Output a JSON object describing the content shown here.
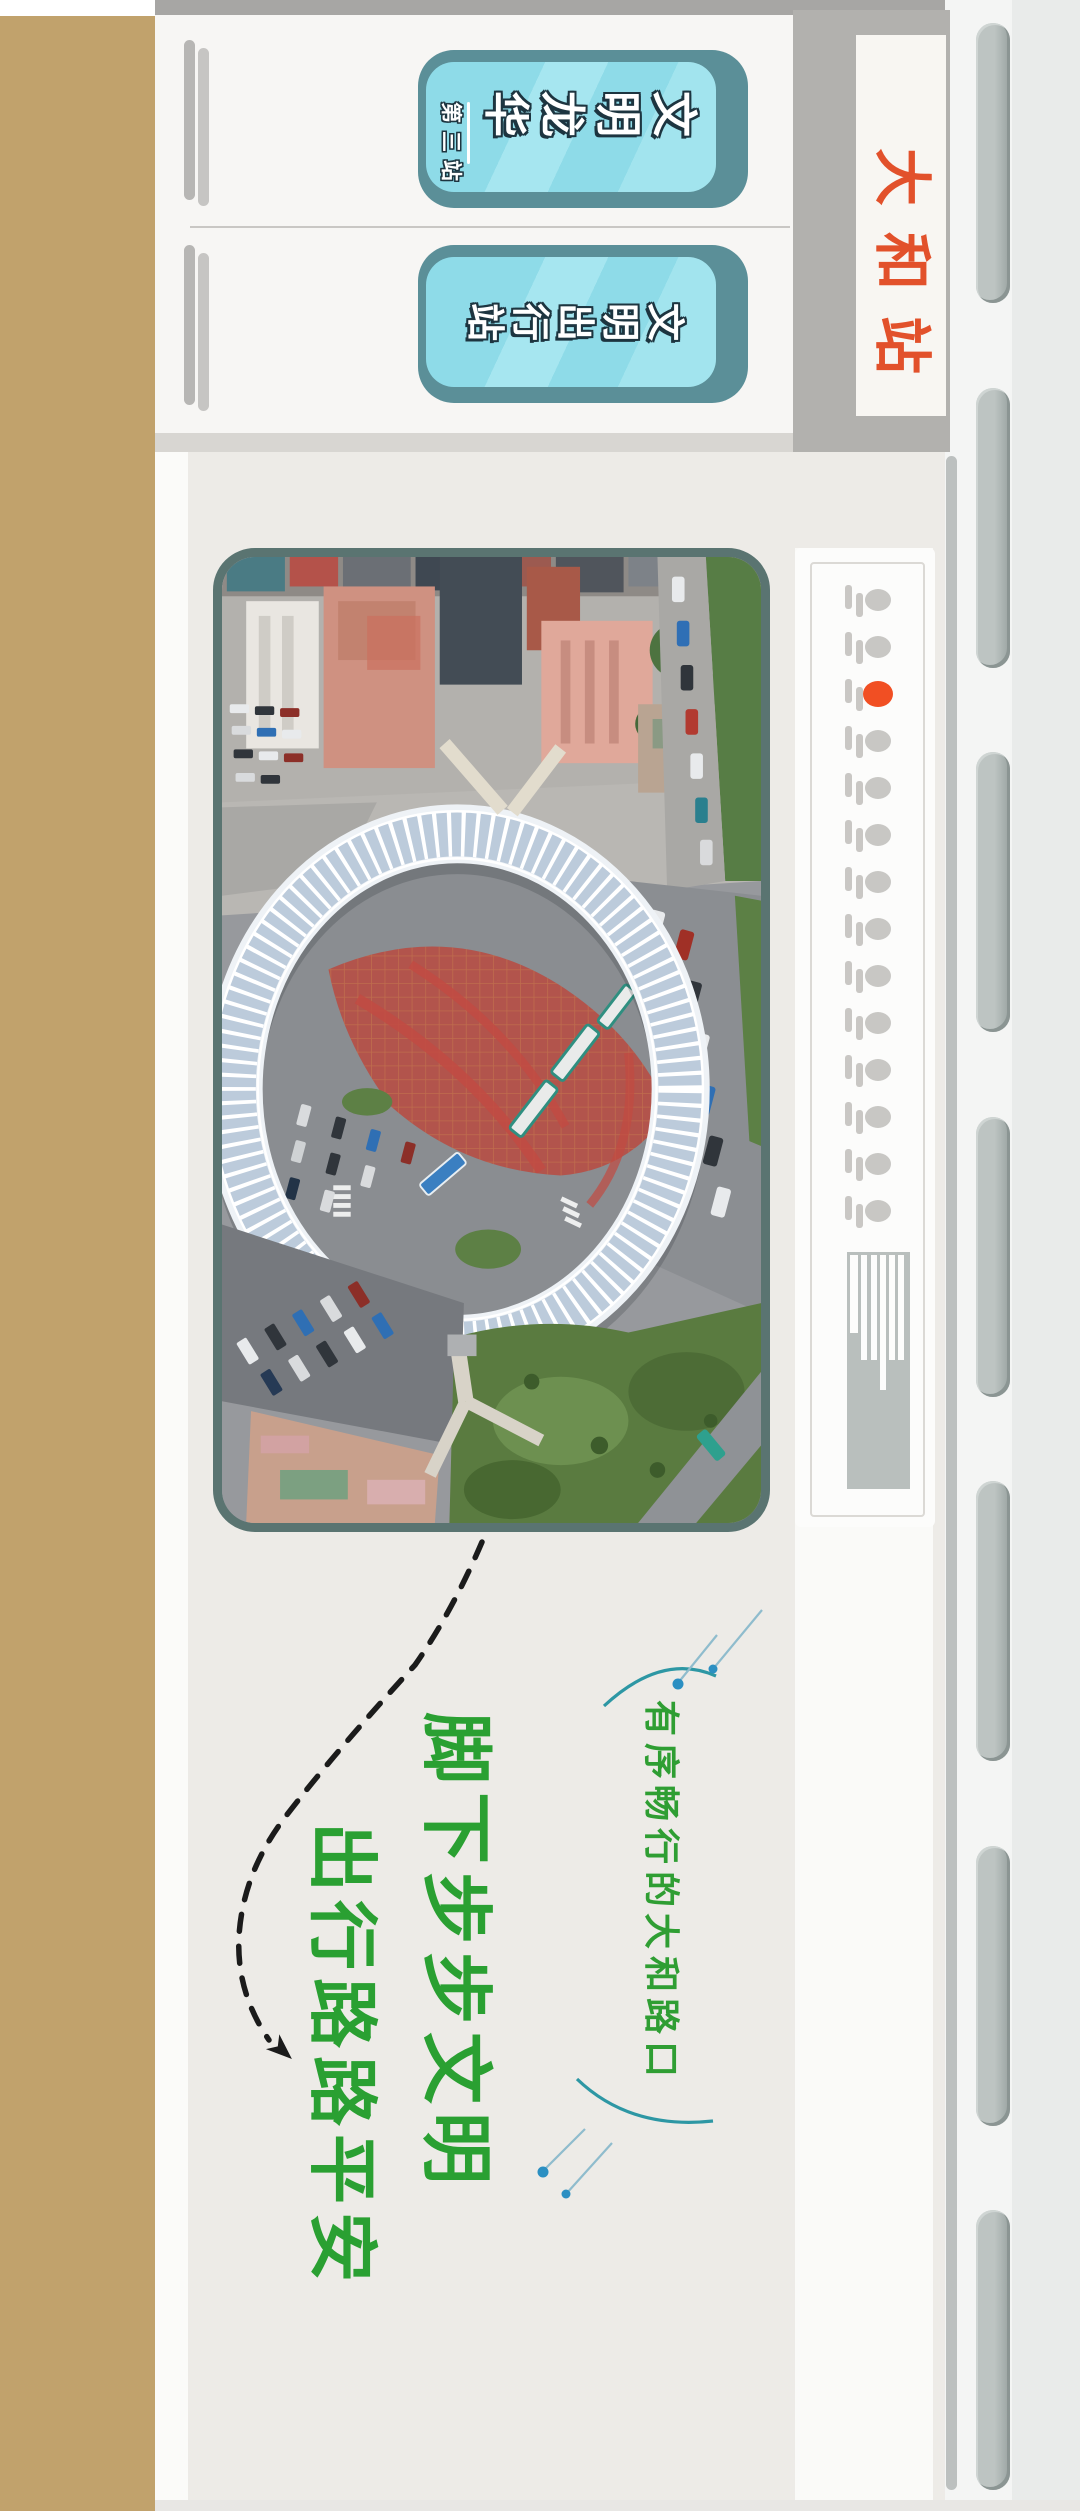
{
  "poster": {
    "series_badge": {
      "main": "文明龙华",
      "sub": "第三站"
    },
    "topic_badge": {
      "main": "文明出行站"
    },
    "station_tag": "大和站",
    "route_panel": {
      "stops_total": 14,
      "active_stop": 3
    },
    "photo_alt": "大和路口环形人行天桥航拍照片",
    "slogan": {
      "column_right": "脚下步步文明",
      "column_left": "出行路路平安"
    },
    "caption": "有序畅行的大和路口",
    "colors": {
      "tan": "#c1a26c",
      "badge_teal": "#8edbe8",
      "badge_dark_teal": "#5b8f98",
      "station_red": "#e2512b",
      "route_active": "#f14f23",
      "slogan_green": "#2aa032",
      "caption_green": "#2f9e33",
      "arc_teal": "#2d97a4",
      "page_beige": "#edebe7"
    }
  }
}
